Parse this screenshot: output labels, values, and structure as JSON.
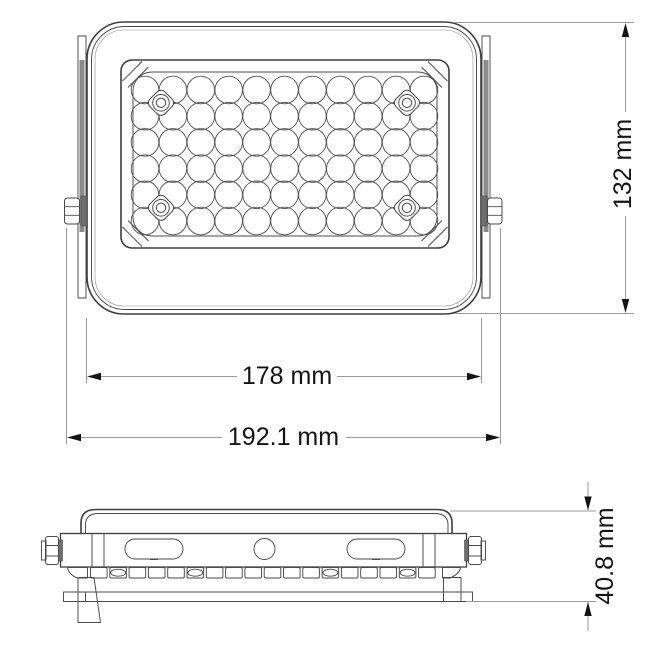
{
  "drawing": {
    "subject": "LED floodlight technical dimension drawing",
    "views": [
      "front",
      "side"
    ]
  },
  "dimensions": {
    "inner_width": "178 mm",
    "outer_width": "192.1 mm",
    "height": "132 mm",
    "depth": "40.8 mm"
  },
  "led_grid": {
    "columns": 11,
    "rows": 6,
    "led_count": 66
  },
  "side_fins": {
    "count": 18,
    "oval_fin_indices": [
      1,
      5,
      12,
      16
    ]
  },
  "colors": {
    "background": "#ffffff",
    "outline": "#3d3d3d",
    "dim_line": "#9a9a9a",
    "dim_text": "#141414",
    "bracket_fill": "#8a8a8a"
  }
}
